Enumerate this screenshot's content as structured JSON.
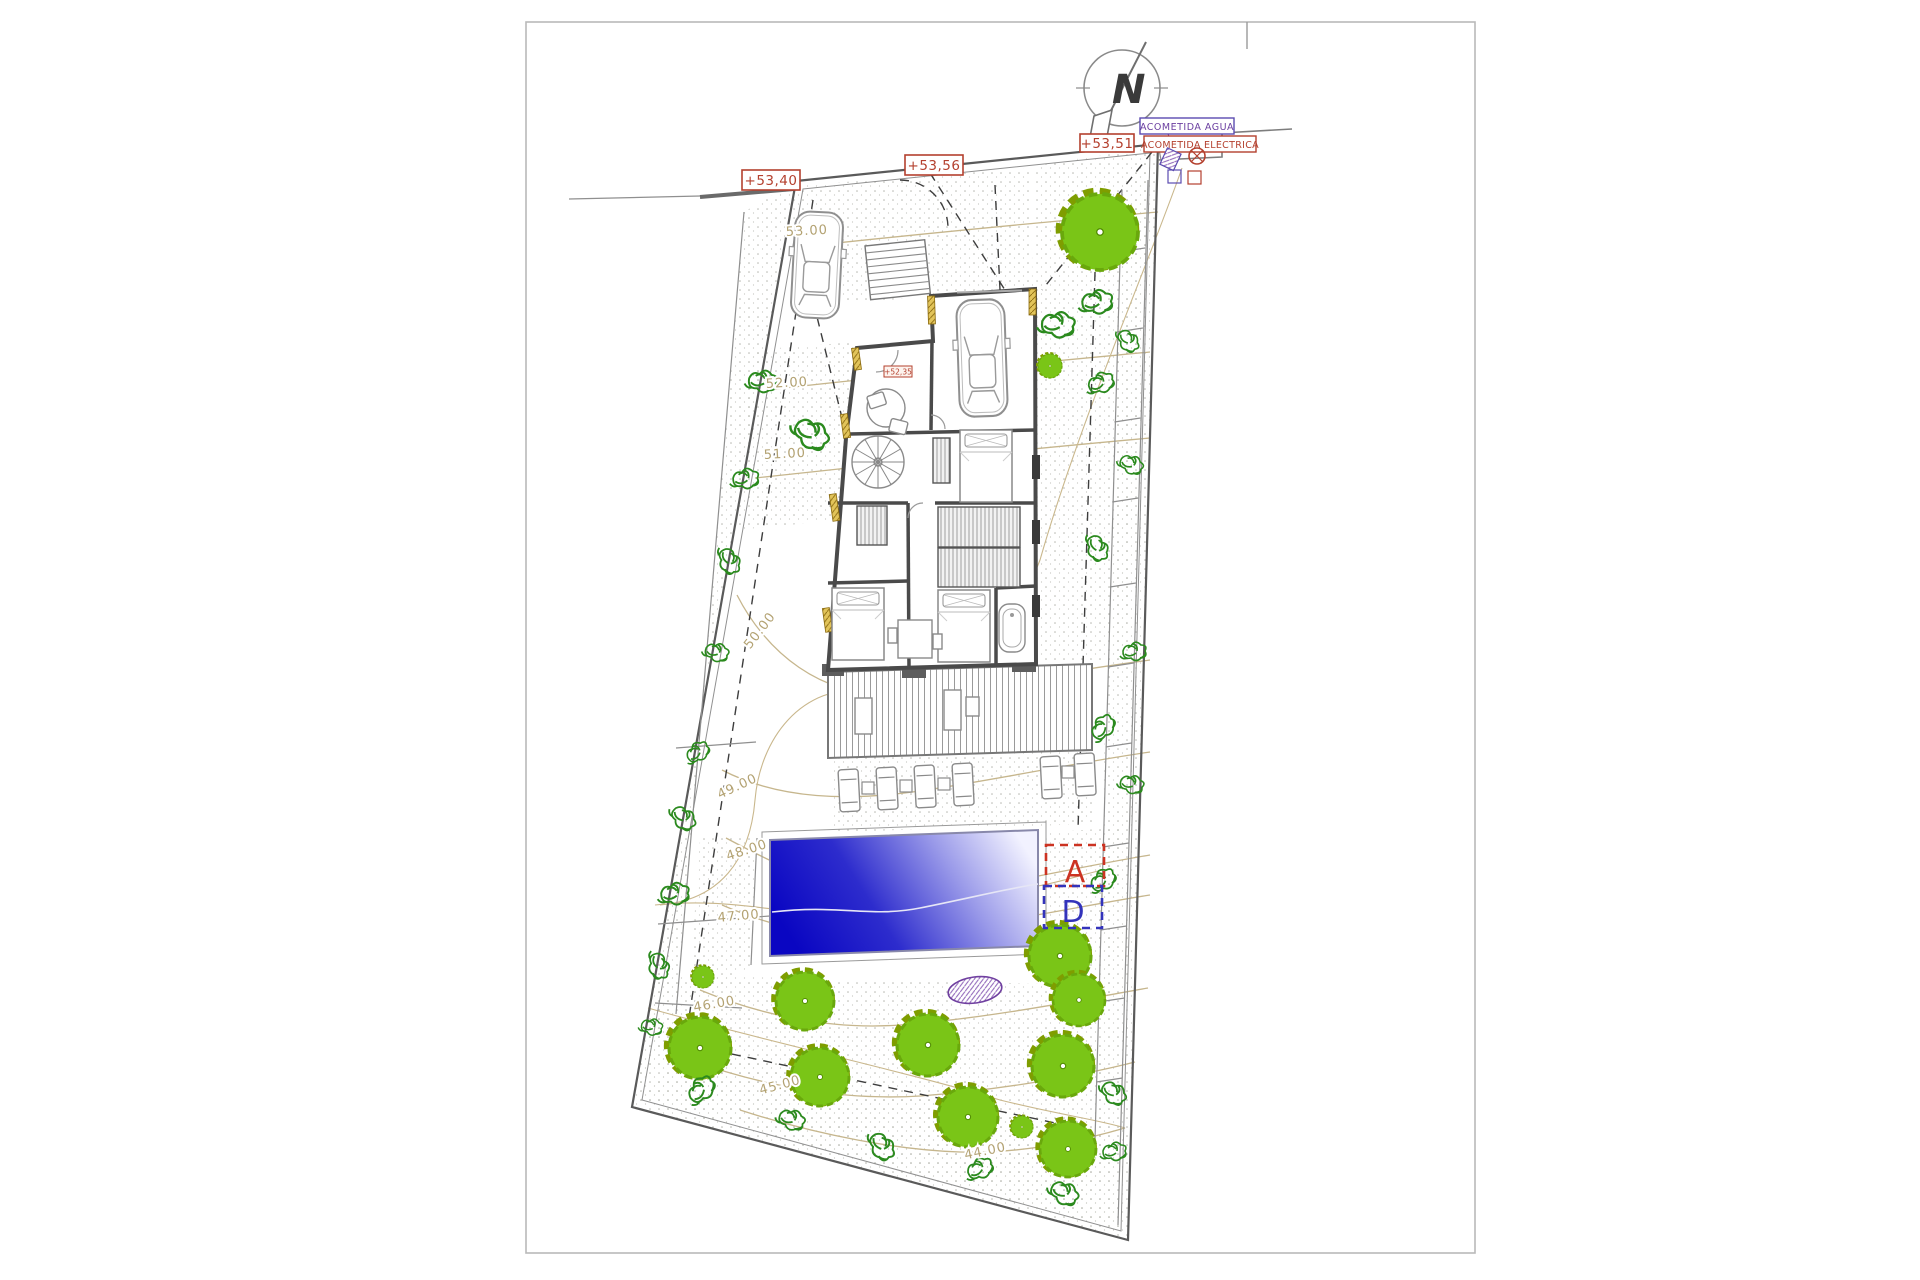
{
  "compass": {
    "north_label": "N"
  },
  "elevation_markers": {
    "street_left": "+53,40",
    "street_mid": "+53,56",
    "street_right": "+53,51",
    "interior": "+52,35"
  },
  "utility_markers": {
    "water": "ACOMETIDA AGUA",
    "electric": "ACOMETIDA ELECTRICA"
  },
  "contour_labels": {
    "c53": "53.00",
    "c52": "52.00",
    "c51": "51.00",
    "c50": "50.00",
    "c49": "49.00",
    "c48": "48.00",
    "c47": "47.00",
    "c46": "46.00",
    "c45": "45.00",
    "c44": "44.00"
  },
  "section_markers": {
    "a": "A",
    "d": "D"
  },
  "colors": {
    "tree_fill": "#7ac517",
    "tree_edge": "#7f9d00",
    "pool_dark": "#0a06c2",
    "pool_light": "#f2f2ff",
    "contour": "#c6b68d",
    "elevation_red": "#b4402e",
    "water_purple": "#6b3fa0",
    "section_a": "#cc3322",
    "section_d": "#3333bb",
    "wall": "#4a4a4a"
  }
}
